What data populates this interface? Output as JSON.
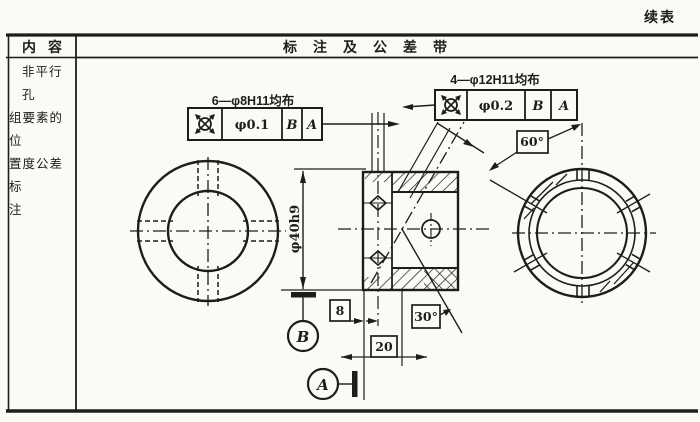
{
  "page": {
    "continued_label": "续表"
  },
  "table": {
    "header_col1": "内容",
    "header_col2": "标注及公差带",
    "row_label_lines": [
      "非平行孔",
      "组要素的位",
      "置度公差标",
      "注"
    ]
  },
  "drawing": {
    "fcf_left": {
      "label": "6—φ8H11均布",
      "tolerance": "φ0.1",
      "datum_primary": "B",
      "datum_secondary": "A"
    },
    "fcf_right": {
      "label": "4—φ12H11均布",
      "tolerance": "φ0.2",
      "datum_primary": "B",
      "datum_secondary": "A"
    },
    "dimensions": {
      "outer_diameter": "φ40h9",
      "hole_offset": "8",
      "hole_spacing": "20",
      "incline_angle": "30°",
      "pattern_angle": "60°"
    },
    "datum_labels": {
      "a": "A",
      "b": "B"
    }
  },
  "colors": {
    "ink": "#1f1d1a",
    "paper": "#fbfaf5"
  }
}
